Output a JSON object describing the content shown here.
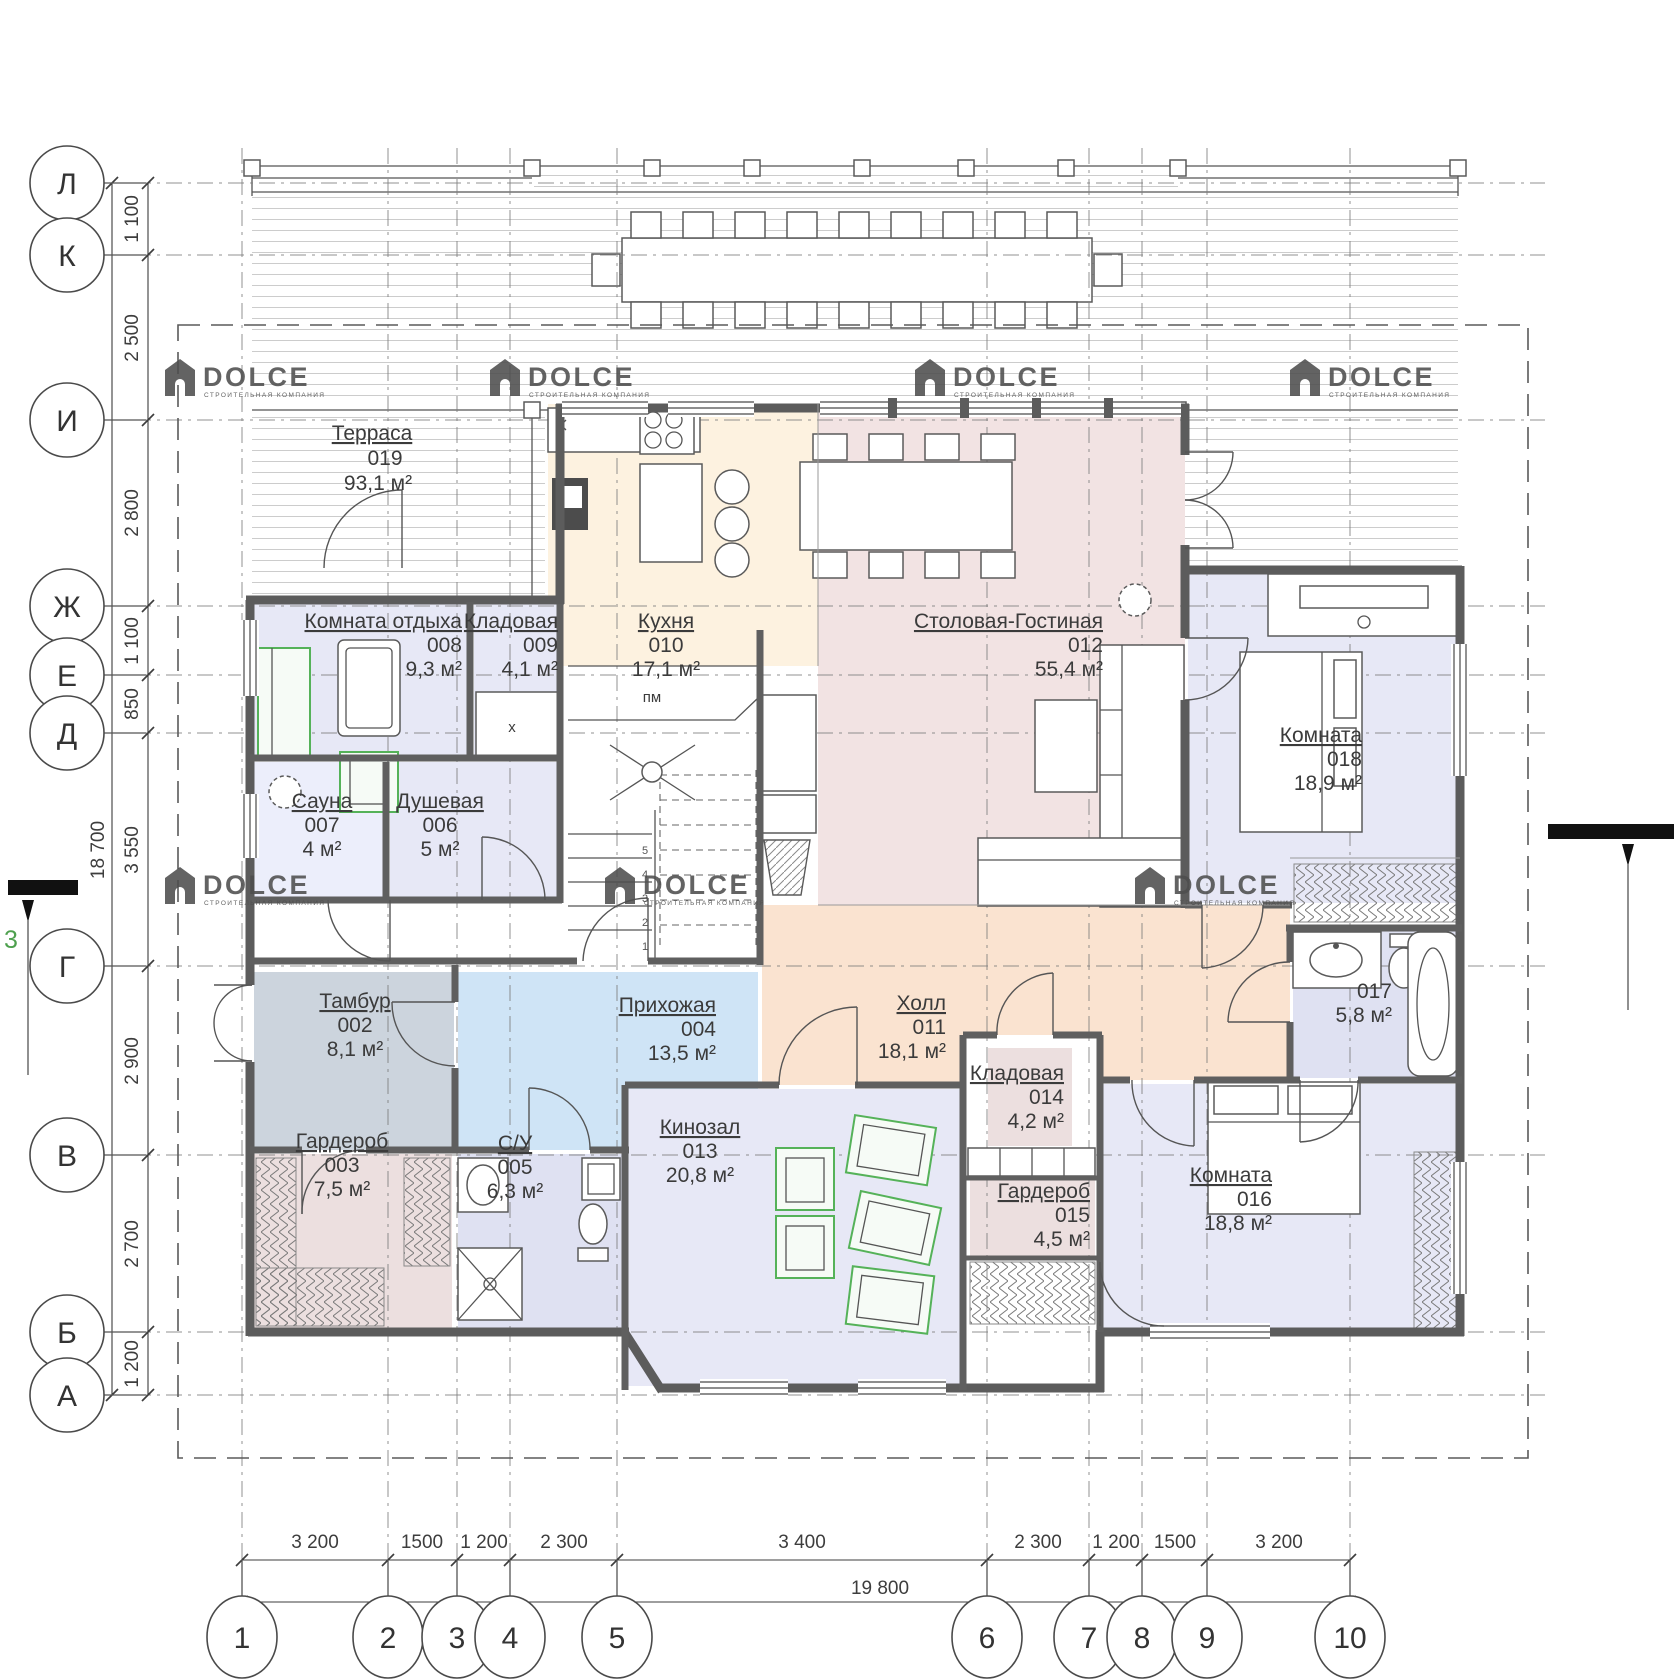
{
  "watermark": {
    "name": "DOLCE",
    "subtitle": "СТРОИТЕЛЬНАЯ КОМПАНИЯ"
  },
  "axes": {
    "rows": [
      {
        "label": "Л"
      },
      {
        "label": "К"
      },
      {
        "label": "И"
      },
      {
        "label": "Ж"
      },
      {
        "label": "Е"
      },
      {
        "label": "Д"
      },
      {
        "label": "Г"
      },
      {
        "label": "В"
      },
      {
        "label": "Б"
      },
      {
        "label": "А"
      }
    ],
    "cols": [
      {
        "label": "1"
      },
      {
        "label": "2"
      },
      {
        "label": "3"
      },
      {
        "label": "4"
      },
      {
        "label": "5"
      },
      {
        "label": "6"
      },
      {
        "label": "7"
      },
      {
        "label": "8"
      },
      {
        "label": "9"
      },
      {
        "label": "10"
      }
    ]
  },
  "dims": {
    "left": [
      "1 100",
      "2 500",
      "2 800",
      "1 100",
      "850",
      "3 550",
      "2 900",
      "2 700",
      "1 200"
    ],
    "left_total": "18 700",
    "bottom": [
      "3 200",
      "1500",
      "1 200",
      "2 300",
      "3 400",
      "2 300",
      "1 200",
      "1500",
      "3 200"
    ],
    "bottom_total": "19 800"
  },
  "rooms": {
    "r002": {
      "name": "Тамбур",
      "num": "002",
      "area": "8,1 м²"
    },
    "r003": {
      "name": "Гардероб",
      "num": "003",
      "area": "7,5 м²"
    },
    "r004": {
      "name": "Прихожая",
      "num": "004",
      "area": "13,5 м²"
    },
    "r005": {
      "name": "С/У",
      "num": "005",
      "area": "6,3 м²"
    },
    "r006": {
      "name": "Душевая",
      "num": "006",
      "area": "5 м²"
    },
    "r007": {
      "name": "Сауна",
      "num": "007",
      "area": "4 м²"
    },
    "r008": {
      "name": "Комната отдыха",
      "num": "008",
      "area": "9,3 м²"
    },
    "r009": {
      "name": "Кладовая",
      "num": "009",
      "area": "4,1 м²"
    },
    "r010": {
      "name": "Кухня",
      "num": "010",
      "area": "17,1 м²"
    },
    "r011": {
      "name": "Холл",
      "num": "011",
      "area": "18,1 м²"
    },
    "r012": {
      "name": "Столовая-Гостиная",
      "num": "012",
      "area": "55,4 м²"
    },
    "r013": {
      "name": "Кинозал",
      "num": "013",
      "area": "20,8 м²"
    },
    "r014": {
      "name": "Кладовая",
      "num": "014",
      "area": "4,2 м²"
    },
    "r015": {
      "name": "Гардероб",
      "num": "015",
      "area": "4,5 м²"
    },
    "r016": {
      "name": "Комната",
      "num": "016",
      "area": "18,8 м²"
    },
    "r017": {
      "num": "017",
      "area": "5,8 м²"
    },
    "r018": {
      "name": "Комната",
      "num": "018",
      "area": "18,9 м²"
    },
    "r019": {
      "name": "Терраса",
      "num": "019",
      "area": "93,1 м²"
    }
  },
  "stairs": {
    "landing": "пм",
    "steps": [
      "1",
      "2",
      "3",
      "4",
      "5"
    ]
  },
  "symbols": {
    "cabinet_mark": "x"
  },
  "section": {
    "label": "3"
  },
  "colors": {
    "kitchen": "#fdf2e0",
    "dining": "#f2e3e3",
    "hall": "#fae3d0",
    "hallway_blue": "#cfe4f6",
    "vestibule_gray": "#ccd4dd",
    "room_lavender": "#e7e8f6",
    "room_lavender2": "#dfe1f2",
    "wardrobe_rose": "#ecdfdf",
    "furniture_green": "#55b259",
    "walls": "#5c5c5c"
  }
}
